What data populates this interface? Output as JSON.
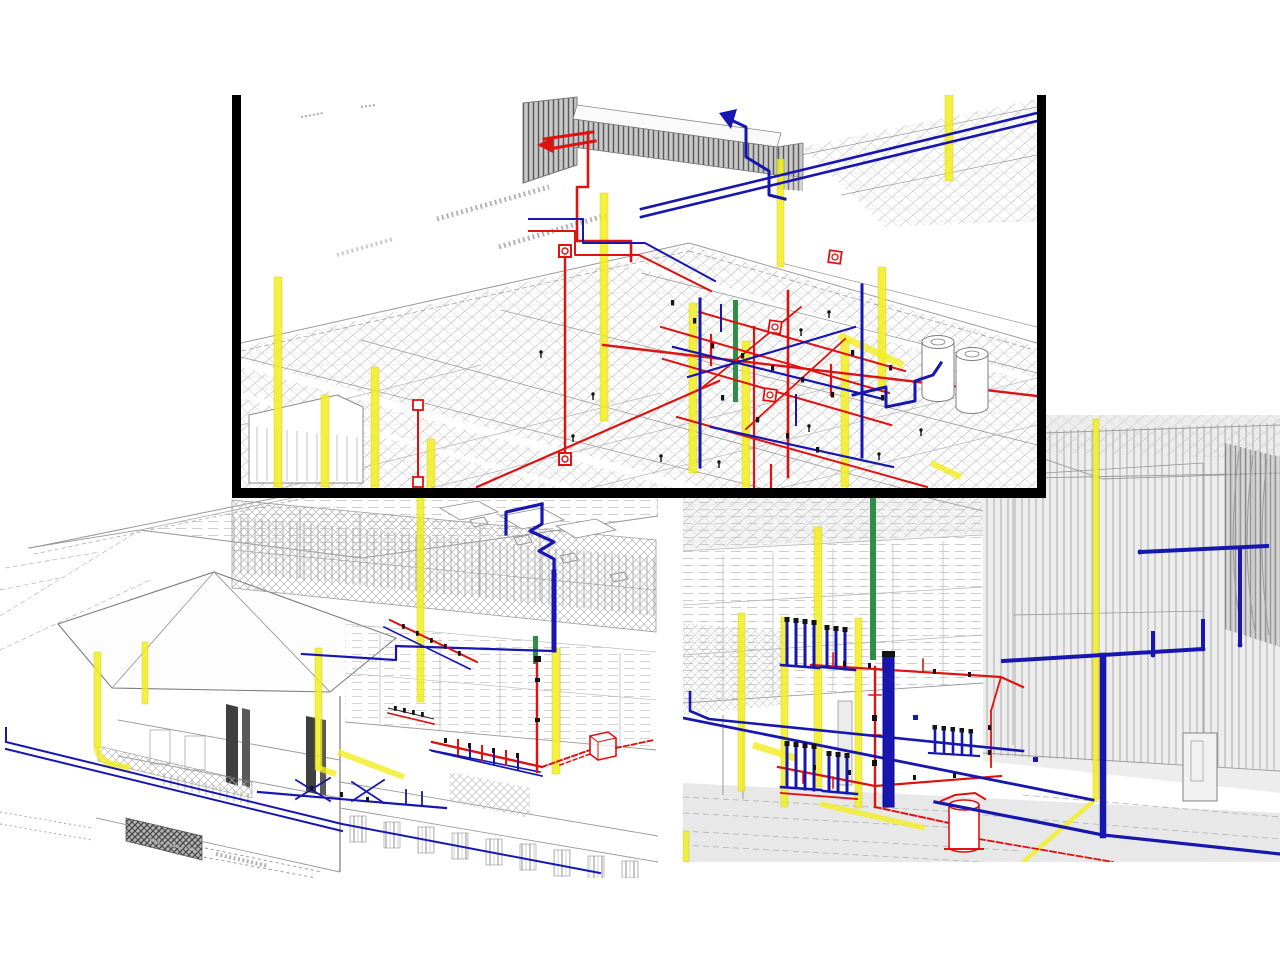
{
  "canvas": {
    "width": 1280,
    "height": 960,
    "background_color": "#ffffff"
  },
  "palette": {
    "piping_red": "#e01111",
    "piping_blue": "#1717b0",
    "piping_yellow": "#f1ee20",
    "piping_green": "#2f8f46",
    "equipment_black": "#131313",
    "wireframe_light": "#b5b5b5",
    "wireframe_mid": "#9a9a9a",
    "wireframe_dark": "#555555",
    "frame_black": "#000000",
    "floor_wash_gray": "#e8e8e8",
    "wall_wash_gray": "#ededed"
  },
  "panels": [
    {
      "id": "roof-axonometric-view",
      "x": 232,
      "y": 95,
      "width": 796,
      "height": 393,
      "z": 2,
      "border": {
        "left": 9,
        "right": 9,
        "bottom": 10,
        "top": 0
      }
    },
    {
      "id": "exterior-perspective-view",
      "x": 0,
      "y": 420,
      "width": 658,
      "height": 458,
      "z": 1,
      "border": null
    },
    {
      "id": "interior-perspective-view",
      "x": 683,
      "y": 415,
      "width": 597,
      "height": 447,
      "z": 1,
      "border": null
    }
  ]
}
